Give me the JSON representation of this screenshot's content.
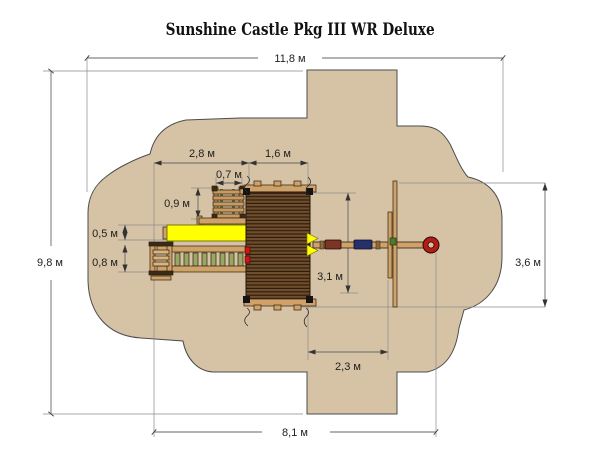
{
  "title": "Sunshine Castle Pkg III WR Deluxe",
  "units": "м",
  "dimensions": {
    "overall_width": "11,8 м",
    "overall_depth": "9,8 м",
    "structure_width": "8,1 м",
    "ladder_slide_span": "2,8 м",
    "deck_width": "1,6 м",
    "climber_width": "0,7 м",
    "climber_depth": "0,9 м",
    "slide_width": "0,5 м",
    "ramp_width": "0,8 м",
    "deck_depth": "3,1 м",
    "swing_offset": "2,3 м",
    "swing_zone_depth": "3,6 м"
  },
  "colors": {
    "safety_zone": "#d6c3a6",
    "wood_beam": "#cfa26a",
    "deck_plank_dark": "#2f1d0c",
    "deck_plank_light": "#6f4e2e",
    "slide_yellow": "#ffff00",
    "swing_seat_red": "#7c3424",
    "swing_seat_blue": "#26306a",
    "tire_swing_red": "#b41c14",
    "rung_green": "#9aa763",
    "dimension_line": "#666666"
  }
}
